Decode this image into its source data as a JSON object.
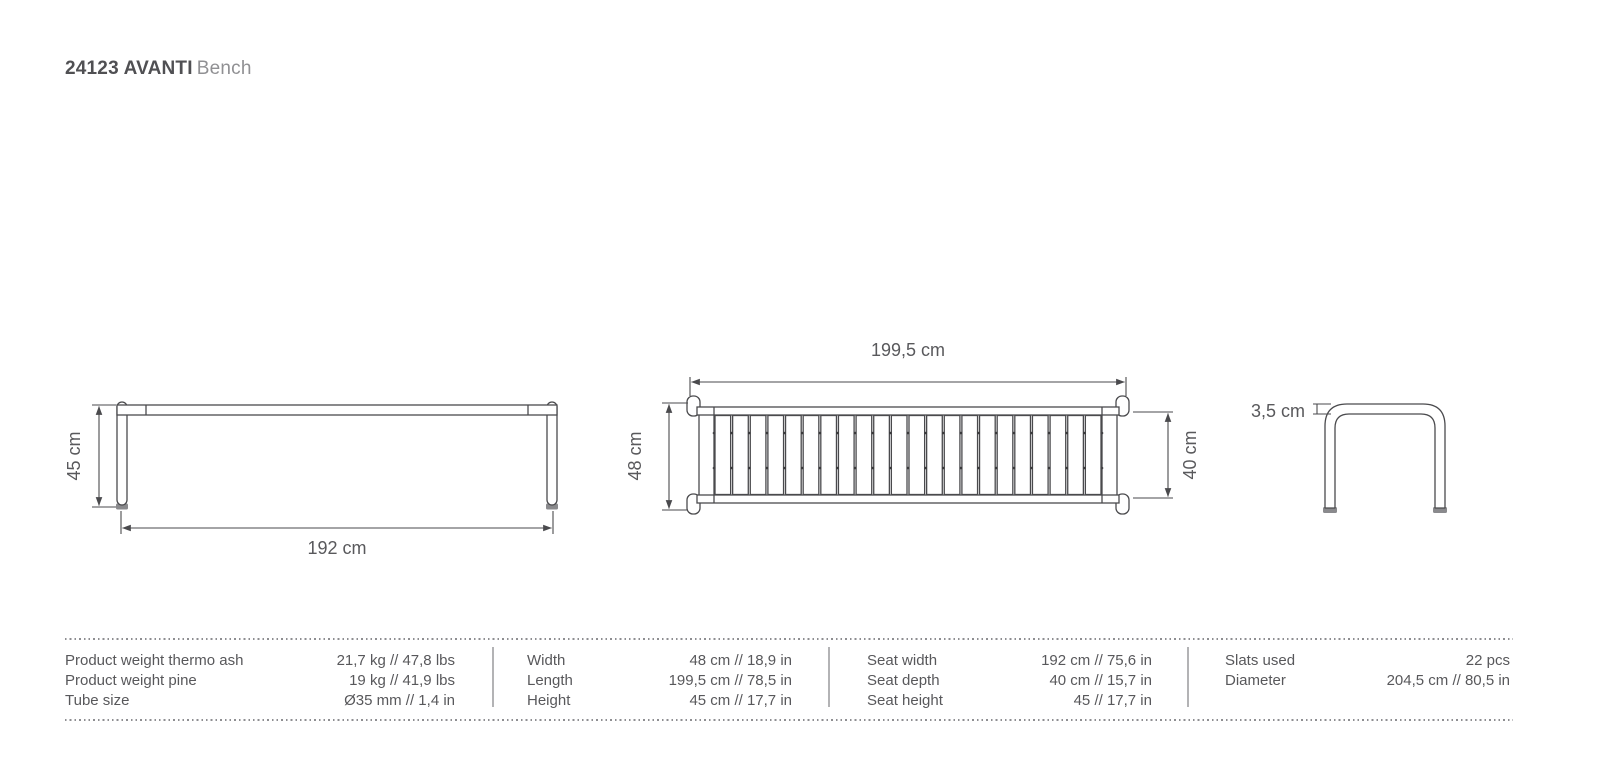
{
  "title": {
    "code_and_name": "24123 AVANTI",
    "suffix": "Bench"
  },
  "colors": {
    "line": "#4a4a4d",
    "dimension_text": "#59595c",
    "title_bold": "#505053",
    "title_light": "#909093",
    "table_text": "#58585b",
    "dotted_rule": "#8e8e91",
    "column_separator": "#b3b3b5",
    "feet_fill": "#8a8a8d",
    "background": "#ffffff"
  },
  "drawing": {
    "front_view": {
      "height_label": "45 cm",
      "width_label": "192 cm"
    },
    "top_view": {
      "length_label": "199,5 cm",
      "depth_label": "48 cm",
      "seat_depth_label": "40 cm",
      "slats_count": 22
    },
    "side_view": {
      "tube_label": "3,5 cm"
    }
  },
  "spec_table": {
    "columns": [
      {
        "rows": [
          {
            "label": "Product weight thermo ash",
            "value": "21,7 kg // 47,8 lbs"
          },
          {
            "label": "Product weight pine",
            "value": "19 kg // 41,9 lbs"
          },
          {
            "label": "Tube size",
            "value": "Ø35 mm // 1,4 in"
          }
        ]
      },
      {
        "rows": [
          {
            "label": "Width",
            "value": "48 cm // 18,9 in"
          },
          {
            "label": "Length",
            "value": "199,5 cm // 78,5 in"
          },
          {
            "label": "Height",
            "value": "45 cm // 17,7 in"
          }
        ]
      },
      {
        "rows": [
          {
            "label": "Seat width",
            "value": "192 cm // 75,6 in"
          },
          {
            "label": "Seat depth",
            "value": "40 cm // 15,7 in"
          },
          {
            "label": "Seat height",
            "value": "45 // 17,7 in"
          }
        ]
      },
      {
        "rows": [
          {
            "label": "Slats used",
            "value": "22 pcs"
          },
          {
            "label": "Diameter",
            "value": "204,5 cm // 80,5 in"
          }
        ]
      }
    ]
  }
}
